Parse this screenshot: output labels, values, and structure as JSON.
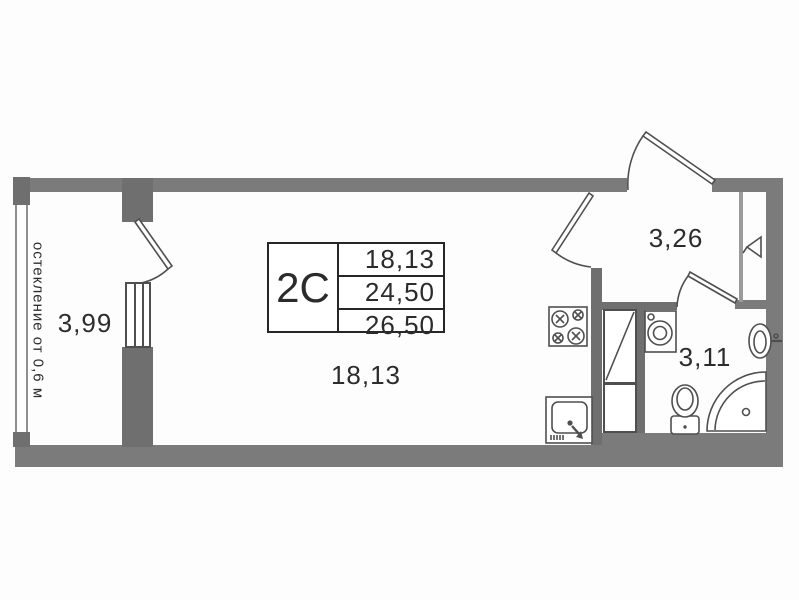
{
  "unit_card": {
    "type": "2C",
    "areas": [
      "18,13",
      "24,50",
      "26,50"
    ]
  },
  "rooms": {
    "balcony_area": "3,99",
    "living_area": "18,13",
    "hall_area": "3,26",
    "bath_area": "3,11"
  },
  "note": {
    "glazing": "остекление от 0,6 м"
  },
  "colors": {
    "wall": "#7b7b7b",
    "wall_dark": "#6f6f6f",
    "wall_light": "#9b9b9b",
    "line": "#4f4f4f",
    "text": "#2d2d2d"
  },
  "icons": {
    "stove": "stove-icon",
    "kitchen_sink": "kitchen-sink-icon",
    "washing_machine": "washing-machine-icon",
    "washbasin": "washbasin-icon",
    "toilet": "toilet-icon",
    "corner_bath": "corner-bathtub-icon",
    "wardrobe": "wardrobe-icon",
    "vent_shaft": "vent-shaft-icon",
    "door": "door-swing-icon",
    "window": "window-icon"
  }
}
